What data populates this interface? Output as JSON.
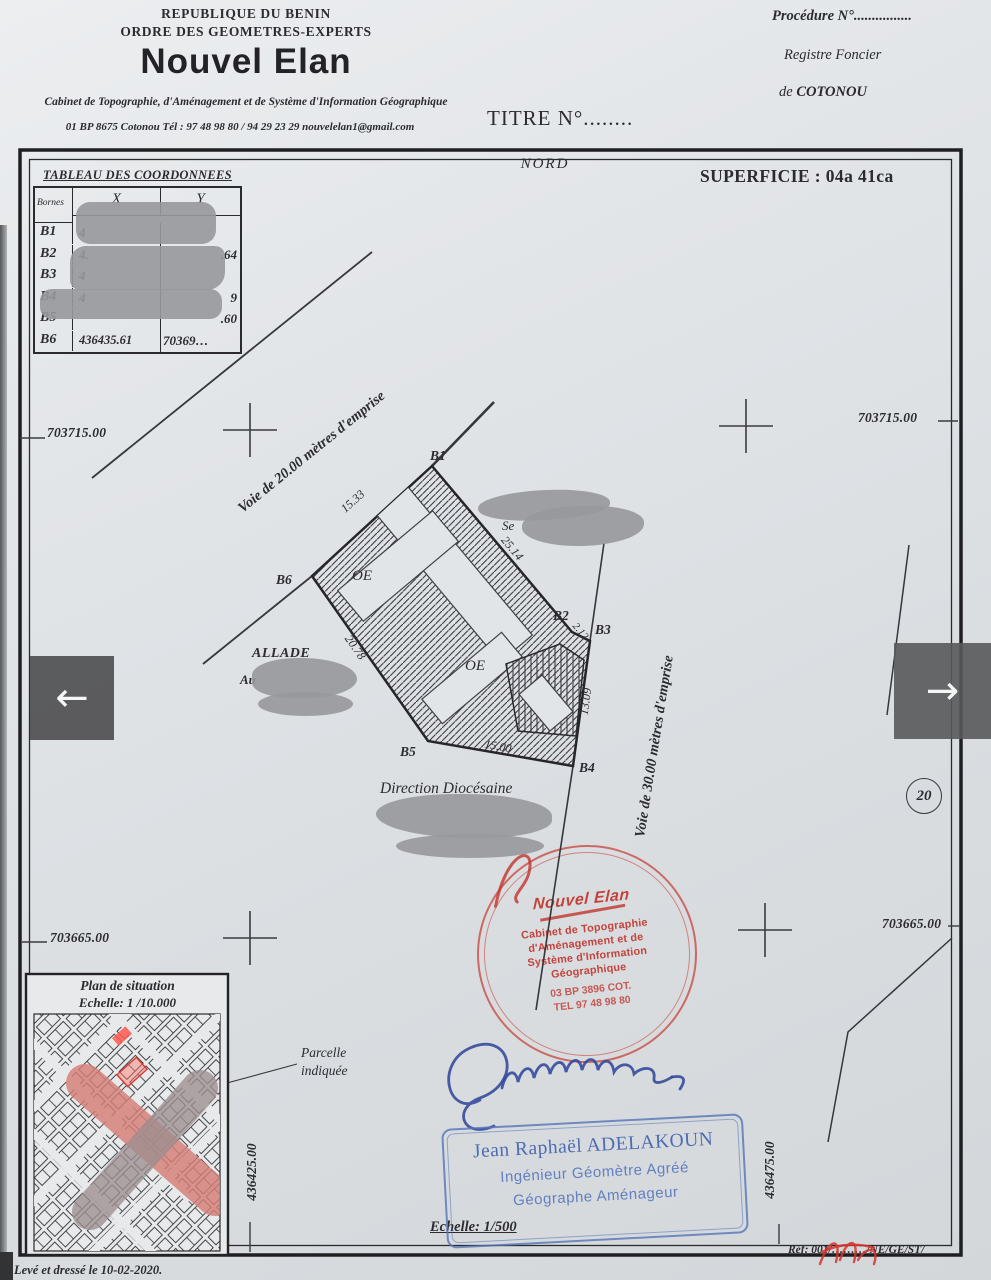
{
  "header": {
    "country": "REPUBLIQUE DU BENIN",
    "order": "ORDRE DES GEOMETRES-EXPERTS",
    "firm": "Nouvel Elan",
    "subtitle": "Cabinet de Topographie, d'Aménagement et de Système d'Information Géographique",
    "contact": "01 BP 8675 Cotonou Tél : 97 48 98 80 / 94 29 23 29 nouvelelan1@gmail.com",
    "procedure": "Procédure N°................",
    "registre_line1": "Registre Foncier",
    "registre_de": "de ",
    "registre_city": "COTONOU",
    "titre": "TITRE N°........"
  },
  "plan": {
    "nord": "NORD",
    "superficie": "SUPERFICIE : 04a 41ca",
    "grid": {
      "nw": "703715.00",
      "ne": "703715.00",
      "sw": "703665.00",
      "se": "703665.00"
    },
    "road20": "Voie de 20.00 mètres d'emprise",
    "road30": "Voie de 30.00 mètres d'emprise",
    "bornes": {
      "b1": "B1",
      "b2": "B2",
      "b3": "B3",
      "b4": "B4",
      "b5": "B5",
      "b6": "B6"
    },
    "dims": {
      "d15_33": "15.33",
      "d25_14": "25.14",
      "d2_12": "2.12",
      "d13_09": "13.09",
      "d15_00": "15.00",
      "d20_78": "20.78"
    },
    "oe1": "OE",
    "oe2": "OE",
    "lot_number": "20",
    "neighbor_fragment": "Se",
    "allade": "ALLADE",
    "allade_fragment": "Au",
    "direction": "Direction Diocésaine",
    "coord_left_vertical": "436425.00",
    "coord_right_vertical": "436475.00",
    "parcelle_label": "Parcelle indiquée"
  },
  "table": {
    "title": "TABLEAU DES COORDONNEES",
    "columns": {
      "bornes": "Bornes",
      "x": "X",
      "y": "Y"
    },
    "rows": [
      {
        "borne": "B1",
        "x": "4",
        "y": ""
      },
      {
        "borne": "B2",
        "x": "4.",
        "y": ".64"
      },
      {
        "borne": "B3",
        "x": "4",
        "y": ""
      },
      {
        "borne": "B4",
        "x": "4",
        "y": "9"
      },
      {
        "borne": "B5",
        "x": "",
        "y": ".60"
      },
      {
        "borne": "B6",
        "x": "436435.61",
        "y": "70369…"
      }
    ]
  },
  "stamp_red": {
    "logo": "Nouvel Elan",
    "line1": "Cabinet de Topographie",
    "line2": "d'Aménagement et de",
    "line3": "Système d'Information",
    "line4": "Géographique",
    "line5": "03 BP 3896 COT.",
    "line6": "TEL  97 48 98 80"
  },
  "stamp_blue": {
    "name": "Jean Raphaël ADELAKOUN",
    "title1": "Ingénieur Géomètre Agréé",
    "title2": "Géographe  Aménageur"
  },
  "situation": {
    "title": "Plan de situation",
    "scale": "Echelle: 1 /10.000"
  },
  "footer": {
    "echelle": "Echelle: 1/500",
    "leve": "Levé et dressé le 10-02-2020.",
    "ref": "Réf: 001/………/NE/GE/ST/"
  },
  "viewer": {
    "prev": "←",
    "next": "→"
  },
  "colors": {
    "stamp_red": "#c8392e",
    "stamp_blue": "#5374b6",
    "redaction": "#97989b",
    "mark_pink": "#d98b85",
    "ink": "#2b2b30"
  }
}
